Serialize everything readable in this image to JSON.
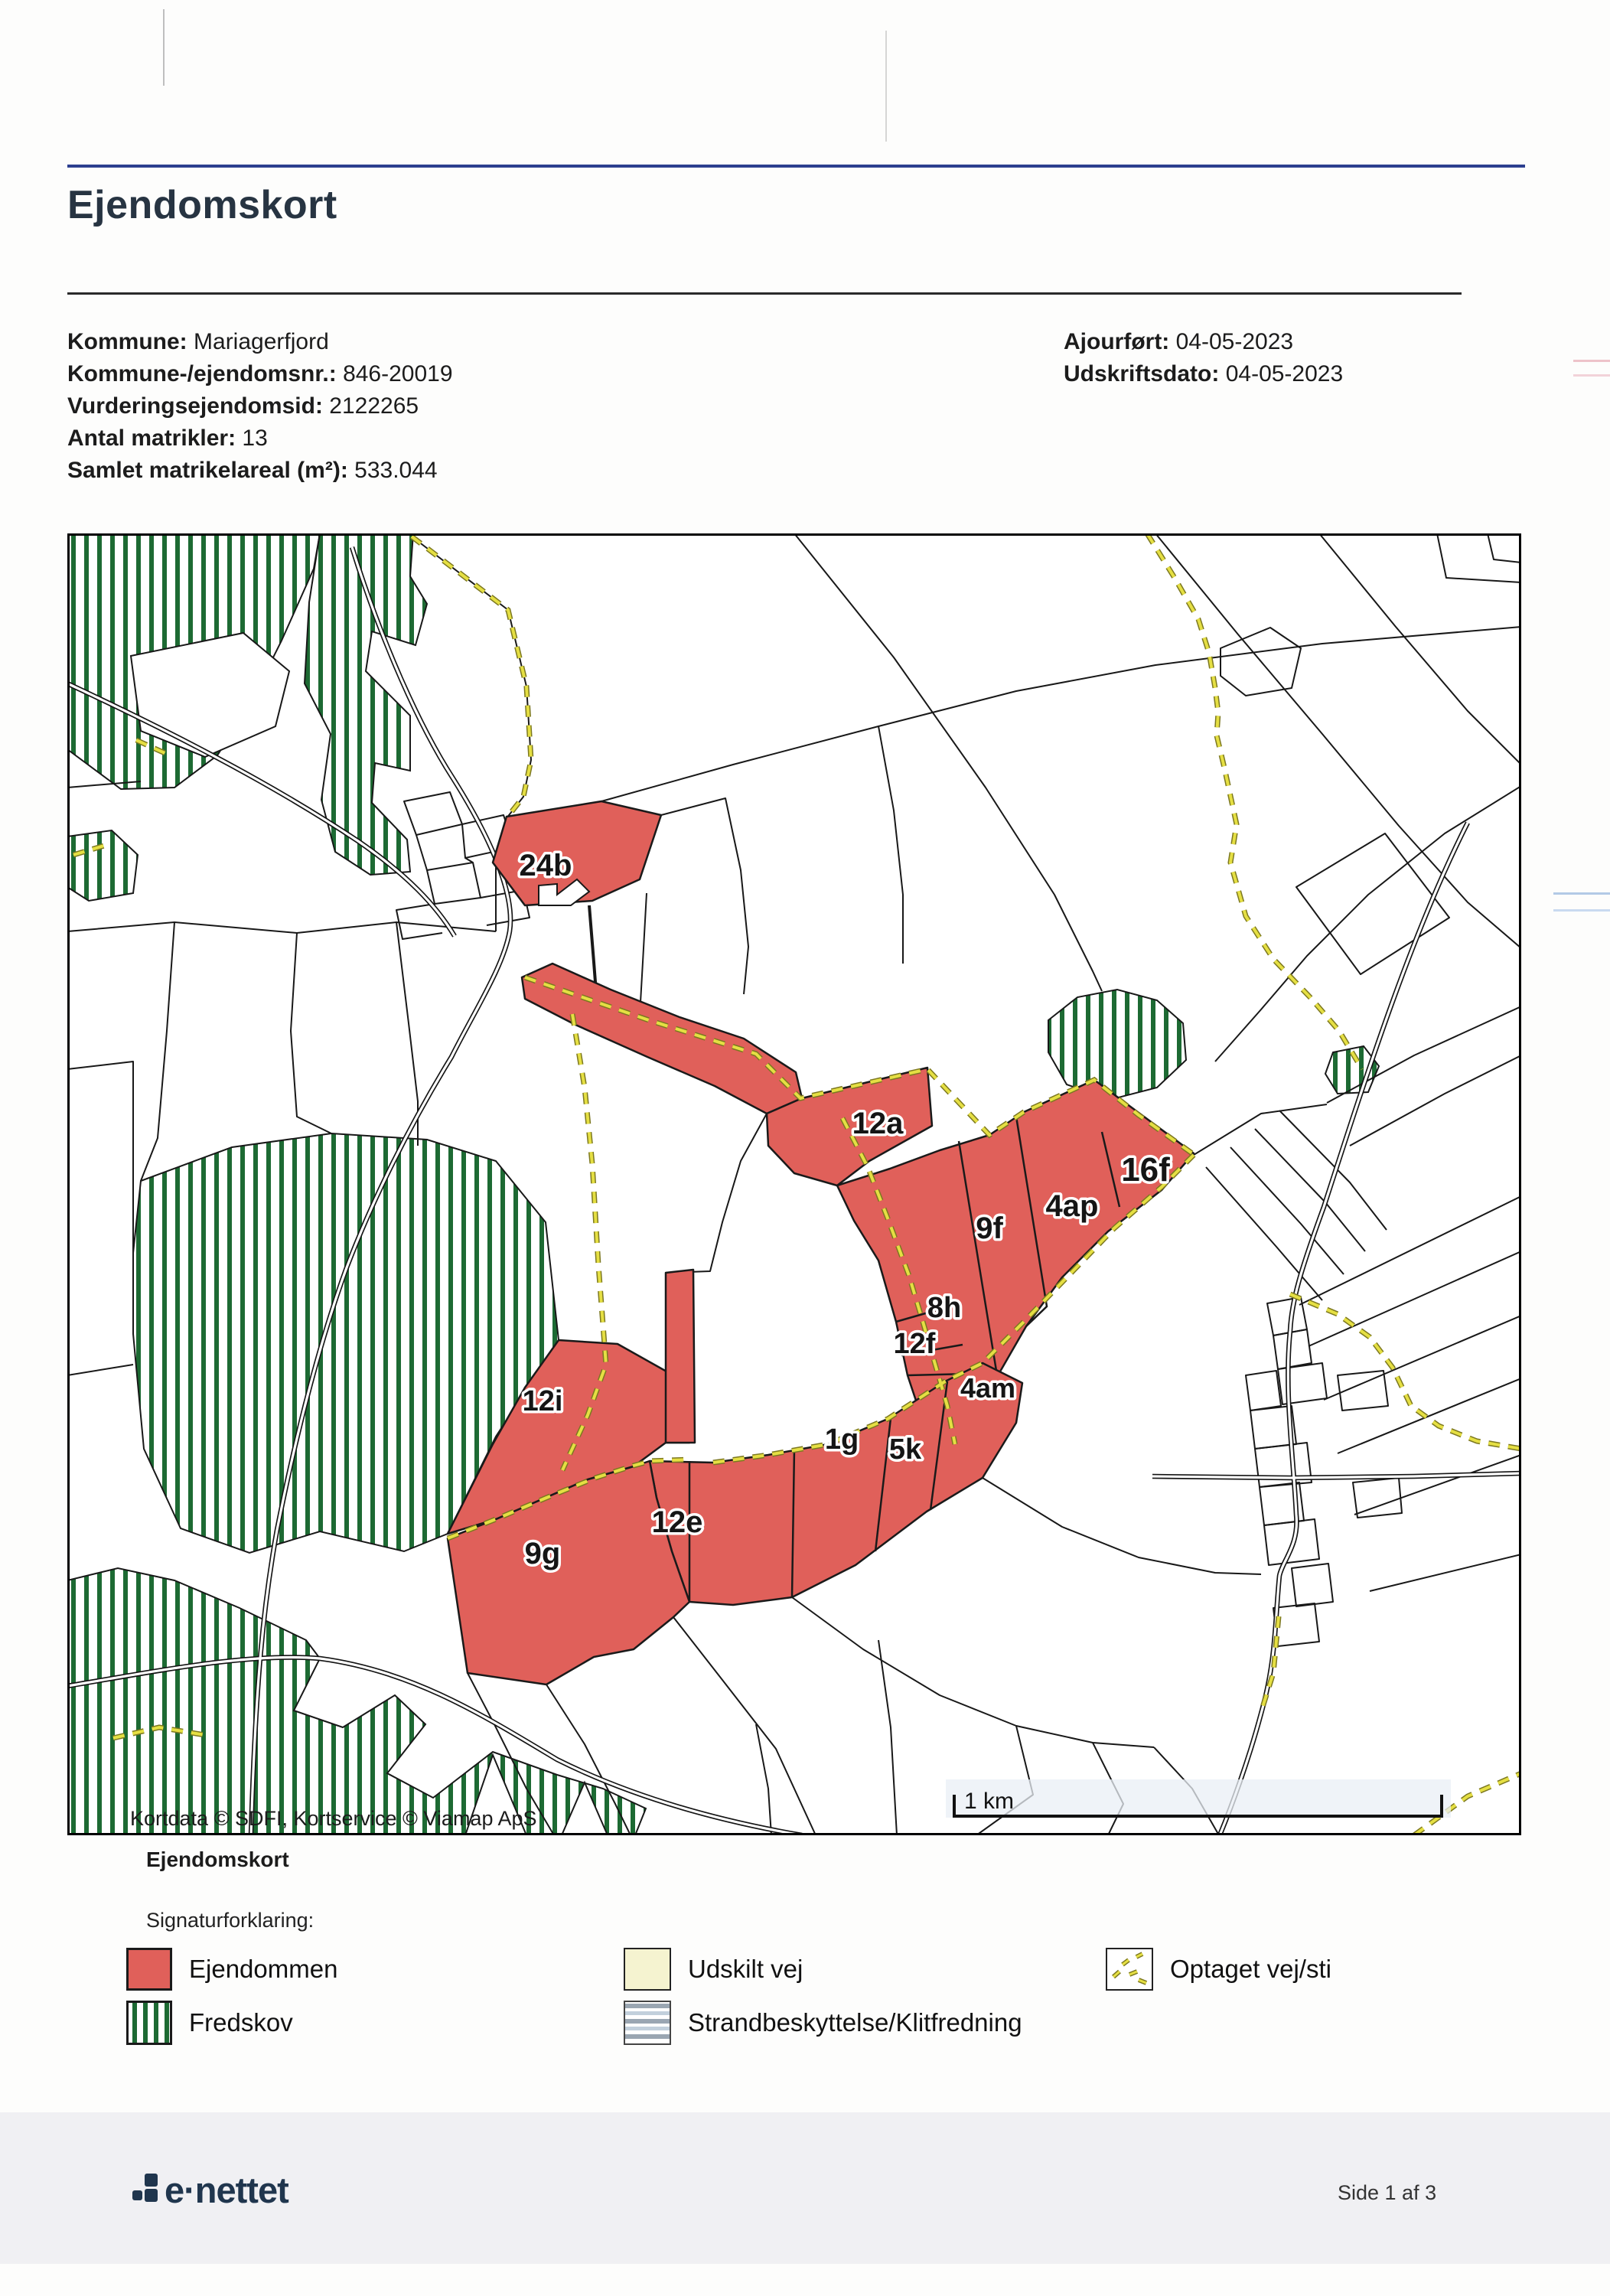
{
  "header": {
    "title": "Ejendomskort"
  },
  "info": {
    "left": [
      {
        "label": "Kommune:",
        "value": "Mariagerfjord"
      },
      {
        "label": "Kommune-/ejendomsnr.:",
        "value": "846-20019"
      },
      {
        "label": "Vurderingsejendomsid:",
        "value": "2122265"
      },
      {
        "label": "Antal matrikler:",
        "value": "13"
      },
      {
        "label": "Samlet matrikelareal (m²):",
        "value": "533.044"
      }
    ],
    "right": [
      {
        "label": "Ajourført:",
        "value": "04-05-2023"
      },
      {
        "label": "Udskriftsdato:",
        "value": "04-05-2023"
      }
    ]
  },
  "map": {
    "caption": "Ejendomskort",
    "attribution": "Kortdata © SDFI, Kortservice © Viamap ApS",
    "scale_label": "1 km",
    "parcel_labels": [
      {
        "text": "24b"
      },
      {
        "text": "12a"
      },
      {
        "text": "16f"
      },
      {
        "text": "4ap"
      },
      {
        "text": "9f"
      },
      {
        "text": "8h"
      },
      {
        "text": "12f"
      },
      {
        "text": "4am"
      },
      {
        "text": "12i"
      },
      {
        "text": "1g"
      },
      {
        "text": "5k"
      },
      {
        "text": "12e"
      },
      {
        "text": "9g"
      }
    ],
    "colors": {
      "property": "#e0605a",
      "forest_stripe": "#1d6a33",
      "path_dash": "#e5df43",
      "udskilt_vej": "#f5f3d0"
    }
  },
  "legend": {
    "heading": "Signaturforklaring:",
    "items": [
      {
        "label": "Ejendommen"
      },
      {
        "label": "Fredskov"
      },
      {
        "label": "Udskilt vej"
      },
      {
        "label": "Strandbeskyttelse/Klitfredning"
      },
      {
        "label": "Optaget vej/sti"
      }
    ]
  },
  "footer": {
    "brand": "e·nettet",
    "page": "Side 1 af 3"
  }
}
